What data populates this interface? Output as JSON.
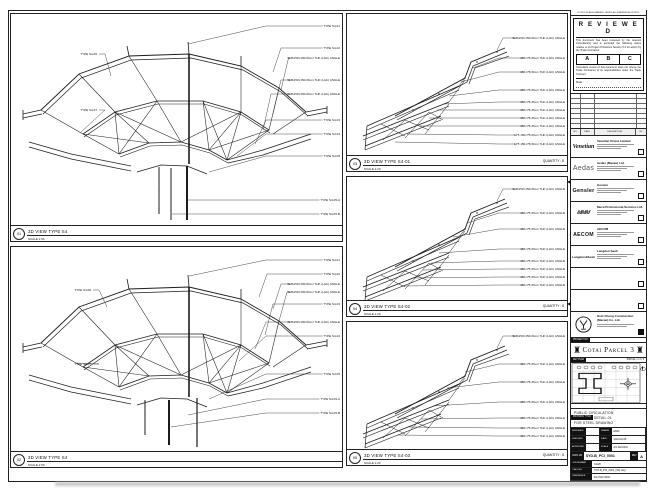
{
  "sheet": {
    "panels": [
      {
        "num": "01",
        "title": "3D VIEW TYPE S4",
        "scale": "SCALE 1:50",
        "callouts_right": [
          "TYPE S4-01",
          "TYPE S4-02",
          "SHS150×150×8mm THK (L&C) ANGLE",
          "SHS150×150×8mm THK (L&C) ANGLE",
          "SHS150×150×8mm THK (L&C) ANGLE",
          "TYPE S4-03",
          "TYPE S4-04",
          "TYPE S4-05",
          "TYPE S4-05-A",
          "TYPE S4-05-B"
        ],
        "callouts_left": [
          "TYPE S4-06",
          "TYPE S4-07"
        ]
      },
      {
        "num": "02",
        "title": "3D VIEW TYPE S4",
        "scale": "SCALE 1:50",
        "callouts_right": [
          "TYPE S4-01",
          "TYPE S4-02",
          "SHS150×150×8mm THK (L&C) ANGLE",
          "SHS150×150×8mm THK (L&C) ANGLE",
          "TYPE S4-03",
          "SHS150×150×8mm THK (L&C) ANGLE",
          "TYPE S4-04",
          "TYPE S4-05",
          "TYPE S4-05-A",
          "TYPE S4-05-B"
        ],
        "callouts_left": [
          "TYPE S4-06",
          "TYPE S4-07"
        ]
      },
      {
        "num": "03",
        "title": "3D VIEW TYPE S4-01",
        "scale": "SCALE 1:20",
        "quantity": "QUANTITY : 8",
        "callouts_right": [
          "SHS150×150×8mm THK (L&C) ANGLE",
          "150×75×8mm THK (L&C) ANGLE",
          "150×75×8mm THK (L&C) ANGLE",
          "150×75×8mm THK (L&C) ANGLE",
          "150×75×8mm THK (L&C) ANGLE",
          "150×75×8mm THK (L&C) ANGLE",
          "150×75×8mm THK (L&C) ANGLE",
          "150×75×8mm THK (L&C) ANGLE",
          "L75 150×75×8mm THK (L&C) ANGLE",
          "L75 150×75×8mm THK (L&C) ANGLE"
        ]
      },
      {
        "num": "04",
        "title": "3D VIEW TYPE S4-02",
        "scale": "SCALE 1:20",
        "quantity": "QUANTITY : 8",
        "callouts_right": [
          "SHS150×150×8mm THK (L&C) ANGLE",
          "150×75×8mm THK (L&C) ANGLE",
          "150×75×8mm THK (L&C) ANGLE",
          "150×75×8mm THK (L&C) ANGLE",
          "150×75×8mm THK (L&C) ANGLE",
          "150×75×8mm THK (L&C) ANGLE",
          "150×75×8mm THK (L&C) ANGLE",
          "150×75×8mm THK (L&C) ANGLE"
        ]
      },
      {
        "num": "05",
        "title": "3D VIEW TYPE S4-03",
        "scale": "SCALE 1:20",
        "quantity": "QUANTITY : 8",
        "callouts_right": [
          "SHS150×150×8mm THK (L&C) ANGLE",
          "150×75×8mm THK (L&C) ANGLE",
          "150×75×8mm THK (L&C) ANGLE",
          "150×75×8mm THK (L&C) ANGLE",
          "150×75×8mm THK (L&C) ANGLE",
          "150×75×8mm THK (L&C) ANGLE",
          "150×75×8mm THK (L&C) ANGLE"
        ]
      }
    ]
  },
  "titleblock": {
    "top_note": "DO NOT SCALE DRAWING. VERIFY ALL DIMENSIONS ON SITE.",
    "reviewed": {
      "title": "R E V I E W E D",
      "para1": "This document has been reviewed by the relevant Consultant(s) and is accorded the following status relative to its Project Provisions Section 5.4 for action by the Trade Contractor.",
      "statuses": [
        "A",
        "B",
        "C"
      ],
      "para2": "Consultant review of this document does not relieve the Trade Contractor of its responsibilities under the Trade Contract.",
      "date_label": "Date :"
    },
    "revisions": {
      "headers": [
        "NO.",
        "DATE",
        "DESCRIPTION",
        "BY"
      ]
    },
    "consultants": [
      {
        "logo": "Venetian",
        "name": "Venetian Orient Limited"
      },
      {
        "logo": "Aedas",
        "name": "Aedas (Macau) Ltd."
      },
      {
        "logo": "Gensler",
        "name": "Gensler"
      },
      {
        "logo": "MMM",
        "name": "Meca Professional Services Ltd."
      },
      {
        "logo": "AECOM",
        "name": "AECOM"
      },
      {
        "logo": "Langdon&Seah",
        "name": "Langdon Seah"
      },
      {
        "logo": "",
        "name": ""
      },
      {
        "logo": "",
        "name": ""
      }
    ],
    "contractor": {
      "name_line1": "Hsin Chong Construction",
      "name_line2": "(Macau) Co. Ltd."
    },
    "project": {
      "band_label": "PROJECT NO.",
      "name": "Cotai Parcel 3",
      "tower_icon": "♜"
    },
    "key_plan": {
      "label": "KEY PLAN",
      "right_label": "PARCEL 1 / 2 / 3"
    },
    "drawing_title": {
      "label": "DRAWING TITLE",
      "lines": [
        "PUBLIC CIRCULATION",
        "FOUNTAIN DETAIL 01",
        "FOR STEEL DRAWING"
      ]
    },
    "signoff": {
      "rows": [
        {
          "l1": "DESIGNED",
          "v1": "-",
          "l2": "DRAWN",
          "v2": "EMO"
        },
        {
          "l1": "CHECKED",
          "v1": "-",
          "l2": "DATE",
          "v2": "14/AUG/15"
        },
        {
          "l1": "APPROVED",
          "v1": "-",
          "l2": "SCALE",
          "v2": "AS SHOWN"
        }
      ]
    },
    "dwg": {
      "label": "DWG NO",
      "value": "SYD-B_PCI_0001",
      "rev_label": "REV",
      "rev": "A"
    },
    "footer": [
      {
        "label": "JOB NUMBER",
        "value": "31128"
      },
      {
        "label": "CAD FILE",
        "value": "SYD-B_PCI_0001_(S4).dwg"
      },
      {
        "label": "REFERENCE",
        "value": "DG P&C 0000"
      }
    ]
  }
}
